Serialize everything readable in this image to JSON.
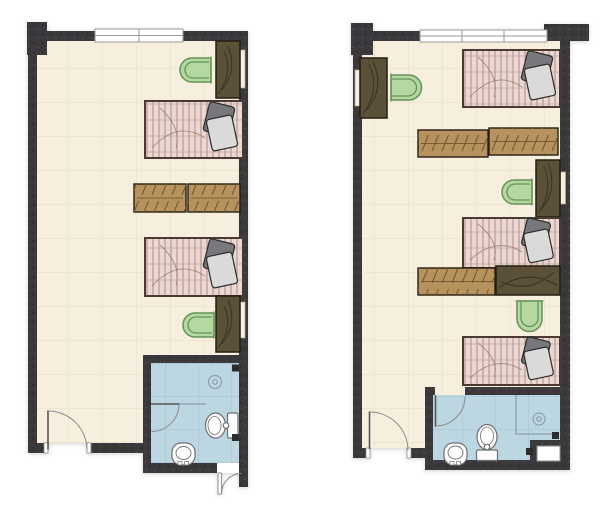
{
  "scene": {
    "type": "architectural floor plans, top-down view",
    "units": 2,
    "background": "#ffffff"
  },
  "colors": {
    "background": "#ffffff",
    "wall": "#3a383b",
    "wall_speck_light": "#504e53",
    "wall_speck_dark": "#252328",
    "floor": "#f6efdd",
    "floor_grid": "#e7ddc3",
    "bath_floor": "#bcd6e2",
    "bath_grid": "#a4c3d2",
    "window_fill": "#ffffff",
    "window_frame": "#9a9a9a",
    "mattress_base": "#ead9d2",
    "mattress_stripe": "#b07d7d",
    "mattress_band": "#c6a59d",
    "mattress_wrinkle": "#97756c",
    "bed_border": "#4a3a30",
    "pillow_dark": "#77787b",
    "pillow_light": "#dadada",
    "pillow_outline": "#2b2b2b",
    "desk_tan": "#b6925f",
    "desk_tan_line": "#74572f",
    "desk_dark": "#5a5138",
    "desk_dark_grain": "#2f2a1a",
    "desk_border": "#241d10",
    "chair_fill": "#b5d8a0",
    "chair_line": "#649359",
    "fixture_fill": "#fdfdfd",
    "fixture_line": "#6f6f6f",
    "door_line": "#555555",
    "door_arc": "#8a8a8a",
    "door_fill": "#ffffff",
    "bath_line": "#8aa0b0",
    "niche_fill": "#f4efe2",
    "niche_edge": "#b0a88f",
    "corner_mark": "#2c2b2e",
    "shaft_fill": "#ffffff",
    "shaft_edge": "#8c8c8c"
  },
  "plans": {
    "left": {
      "id": "unit-left",
      "beds": 2,
      "dark_single_desks": 2,
      "tan_paired_desks": 2,
      "chairs": 2,
      "windows": 1,
      "doors": [
        "entry-door-bottom-left",
        "bathroom-door",
        "exterior-door-bottom-right"
      ],
      "bathroom_fixtures": [
        "floor-drain",
        "toilet",
        "washbasin"
      ]
    },
    "right": {
      "id": "unit-right",
      "beds": 3,
      "dark_single_desks": 3,
      "tan_desks": 3,
      "chairs": 3,
      "windows": 1,
      "doors": [
        "entry-door-bottom-left",
        "bathroom-door"
      ],
      "bathroom_fixtures": [
        "floor-drain",
        "toilet",
        "washbasin",
        "service-shaft"
      ]
    }
  }
}
